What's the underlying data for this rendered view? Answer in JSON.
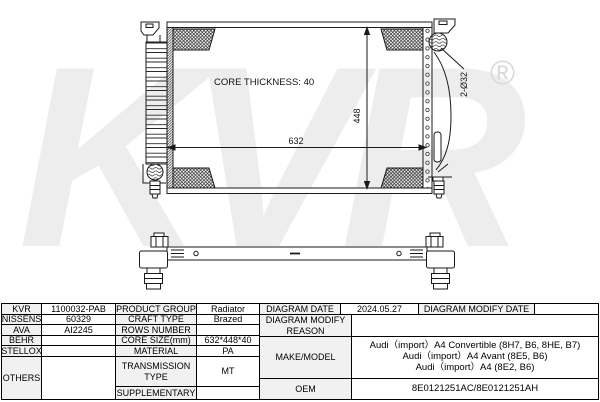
{
  "watermark": {
    "brand": "KVR",
    "registered": "®"
  },
  "diagram": {
    "core_thickness_label": "CORE THICKNESS: 40",
    "width_dim": "632",
    "height_dim": "448",
    "pipe_dim": "2-Ø32"
  },
  "left_table": {
    "rows": [
      {
        "brand": "KVR",
        "code": "1100032-PAB",
        "label": "PRODUCT GROUP",
        "value": "Radiator"
      },
      {
        "brand": "NISSENS",
        "code": "60329",
        "label": "CRAFT TYPE",
        "value": "Brazed"
      },
      {
        "brand": "AVA",
        "code": "AI2245",
        "label": "ROWS NUMBER",
        "value": ""
      },
      {
        "brand": "BEHR",
        "code": "",
        "label": "CORE SIZE(mm)",
        "value": "632*448*40"
      },
      {
        "brand": "STELLOX",
        "code": "",
        "label": "MATERIAL",
        "value": "PA"
      },
      {
        "brand": "OTHERS",
        "code": "",
        "label": "TRANSMISSION TYPE",
        "value": "MT"
      },
      {
        "brand": "",
        "code": "",
        "label": "SUPPLEMENTARY",
        "value": ""
      }
    ]
  },
  "right_table": {
    "diagram_date_label": "DIAGRAM DATE",
    "diagram_date": "2024.05.27",
    "modify_date_label": "DIAGRAM MODIFY DATE",
    "modify_date": "",
    "modify_reason_label": "DIAGRAM MODIFY REASON",
    "modify_reason": "",
    "make_model_label": "MAKE/MODEL",
    "make_model": [
      "Audi（import）A4 Convertible (8H7, B6, 8HE, B7)",
      "Audi（import）A4 Avant (8E5, B6)",
      "Audi（import）A4 (8E2, B6)"
    ],
    "oem_label": "OEM",
    "oem": "8E0121251AC/8E0121251AH"
  }
}
